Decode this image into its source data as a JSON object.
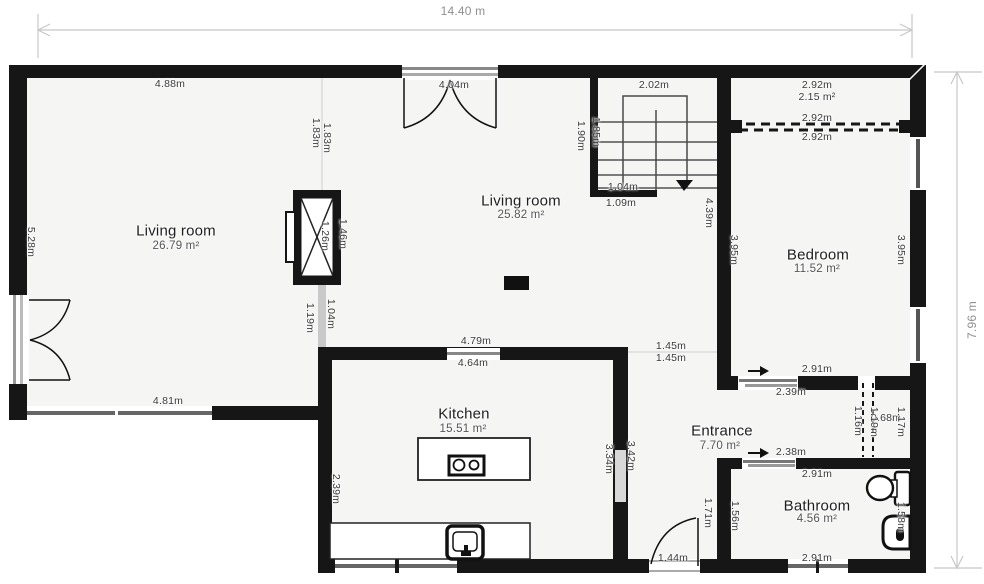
{
  "title": "Floor plan",
  "overall": {
    "width_label": "14.40 m",
    "height_label": "7.96 m"
  },
  "colors": {
    "wall": "#161616",
    "floor": "#f5f5f4",
    "outside": "#ffffff",
    "window_glass": "#666666",
    "opening": "#d8d8d8",
    "dimension_line": "#c8c8c8",
    "dimension_text": "#8f8f8f",
    "plan_text": "#3a3a3a"
  },
  "rooms": [
    {
      "name": "Living room",
      "area": "26.79 m²",
      "nx": 176,
      "ny": 231,
      "ax": 176,
      "ay": 246
    },
    {
      "name": "Living room",
      "area": "25.82 m²",
      "nx": 521,
      "ny": 201,
      "ax": 521,
      "ay": 215
    },
    {
      "name": "Bedroom",
      "area": "11.52 m²",
      "nx": 818,
      "ny": 255,
      "ax": 817,
      "ay": 269
    },
    {
      "name": "Kitchen",
      "area": "15.51 m²",
      "nx": 464,
      "ny": 414,
      "ax": 463,
      "ay": 429
    },
    {
      "name": "Entrance",
      "area": "7.70 m²",
      "nx": 722,
      "ny": 431,
      "ax": 720,
      "ay": 446
    },
    {
      "name": "Bathroom",
      "area": "4.56 m²",
      "nx": 817,
      "ny": 506,
      "ax": 817,
      "ay": 519
    }
  ],
  "labels": [
    {
      "t": "14.40 m",
      "x": 463,
      "y": 11,
      "k": "big"
    },
    {
      "t": "7.96 m",
      "x": 972,
      "y": 320,
      "k": "bigv"
    },
    {
      "t": "4.88m",
      "x": 170,
      "y": 84,
      "k": "dim"
    },
    {
      "t": "4.04m",
      "x": 454,
      "y": 85,
      "k": "dim"
    },
    {
      "t": "2.02m",
      "x": 654,
      "y": 85,
      "k": "dim"
    },
    {
      "t": "2.92m",
      "x": 817,
      "y": 85,
      "k": "dim"
    },
    {
      "t": "2.15 m²",
      "x": 817,
      "y": 97,
      "k": "dim"
    },
    {
      "t": "2.92m",
      "x": 817,
      "y": 118,
      "k": "dim"
    },
    {
      "t": "2.92m",
      "x": 817,
      "y": 137,
      "k": "dim"
    },
    {
      "t": "1.04m",
      "x": 623,
      "y": 187,
      "k": "dim"
    },
    {
      "t": "1.09m",
      "x": 621,
      "y": 203,
      "k": "dim"
    },
    {
      "t": "4.81m",
      "x": 168,
      "y": 401,
      "k": "dim"
    },
    {
      "t": "4.79m",
      "x": 476,
      "y": 341,
      "k": "dim"
    },
    {
      "t": "4.64m",
      "x": 473,
      "y": 363,
      "k": "dim"
    },
    {
      "t": "1.45m",
      "x": 671,
      "y": 346,
      "k": "dim"
    },
    {
      "t": "1.45m",
      "x": 671,
      "y": 358,
      "k": "dim"
    },
    {
      "t": "2.91m",
      "x": 817,
      "y": 369,
      "k": "dim"
    },
    {
      "t": "2.39m",
      "x": 791,
      "y": 392,
      "k": "dim"
    },
    {
      "t": "2.38m",
      "x": 791,
      "y": 452,
      "k": "dim"
    },
    {
      "t": "2.91m",
      "x": 817,
      "y": 474,
      "k": "dim"
    },
    {
      "t": "2.91m",
      "x": 817,
      "y": 558,
      "k": "dim"
    },
    {
      "t": "1.44m",
      "x": 673,
      "y": 558,
      "k": "dim"
    },
    {
      "t": "0.68m",
      "x": 886,
      "y": 418,
      "k": "dim"
    },
    {
      "t": "1.83m",
      "x": 316,
      "y": 133,
      "k": "dimv"
    },
    {
      "t": "1.83m",
      "x": 327,
      "y": 138,
      "k": "dimv"
    },
    {
      "t": "1.90m",
      "x": 581,
      "y": 136,
      "k": "dimv"
    },
    {
      "t": "1.85m",
      "x": 596,
      "y": 132,
      "k": "dimv"
    },
    {
      "t": "4.39m",
      "x": 709,
      "y": 213,
      "k": "dimv"
    },
    {
      "t": "3.95m",
      "x": 734,
      "y": 250,
      "k": "dimv"
    },
    {
      "t": "3.95m",
      "x": 901,
      "y": 250,
      "k": "dimv"
    },
    {
      "t": "5.28m",
      "x": 31,
      "y": 242,
      "k": "dimv"
    },
    {
      "t": "1.26m",
      "x": 325,
      "y": 236,
      "k": "dimv"
    },
    {
      "t": "1.46m",
      "x": 343,
      "y": 234,
      "k": "dimv"
    },
    {
      "t": "1.19m",
      "x": 310,
      "y": 318,
      "k": "dimv"
    },
    {
      "t": "1.04m",
      "x": 331,
      "y": 314,
      "k": "dimv"
    },
    {
      "t": "2.39m",
      "x": 336,
      "y": 489,
      "k": "dimv"
    },
    {
      "t": "3.34m",
      "x": 609,
      "y": 459,
      "k": "dimv"
    },
    {
      "t": "3.42m",
      "x": 631,
      "y": 456,
      "k": "dimv"
    },
    {
      "t": "1.71m",
      "x": 708,
      "y": 513,
      "k": "dimv"
    },
    {
      "t": "1.56m",
      "x": 735,
      "y": 516,
      "k": "dimv"
    },
    {
      "t": "1.58m",
      "x": 901,
      "y": 517,
      "k": "dimv"
    },
    {
      "t": "1.16m",
      "x": 858,
      "y": 421,
      "k": "dimv"
    },
    {
      "t": "1.19m",
      "x": 874,
      "y": 422,
      "k": "dimv"
    },
    {
      "t": "1.17m",
      "x": 901,
      "y": 422,
      "k": "dimv"
    }
  ]
}
